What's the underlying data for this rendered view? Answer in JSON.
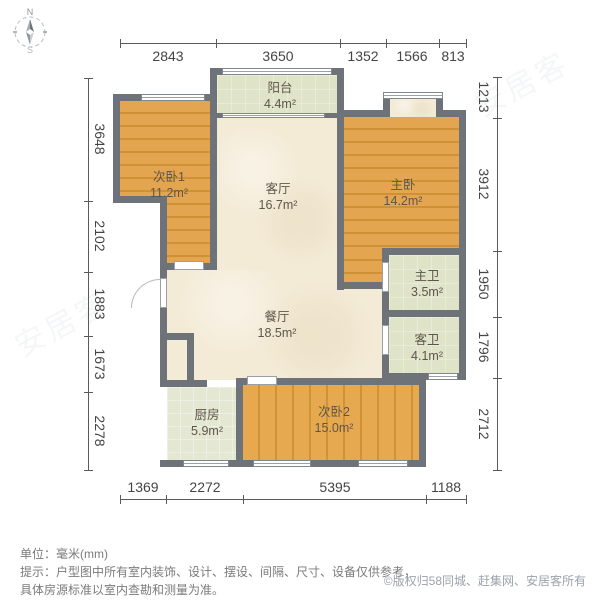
{
  "compass": {
    "north": "N",
    "south": "S"
  },
  "rooms": [
    {
      "id": "bedroom2-1",
      "name": "次卧1",
      "area": "11.2m²",
      "floor": "wood"
    },
    {
      "id": "balcony",
      "name": "阳台",
      "area": "4.4m²",
      "floor": "tile"
    },
    {
      "id": "living",
      "name": "客厅",
      "area": "16.7m²",
      "floor": "marble"
    },
    {
      "id": "master",
      "name": "主卧",
      "area": "14.2m²",
      "floor": "wood"
    },
    {
      "id": "master-bath",
      "name": "主卫",
      "area": "3.5m²",
      "floor": "tile"
    },
    {
      "id": "guest-bath",
      "name": "客卫",
      "area": "4.1m²",
      "floor": "tile"
    },
    {
      "id": "dining",
      "name": "餐厅",
      "area": "18.5m²",
      "floor": "marble"
    },
    {
      "id": "kitchen",
      "name": "厨房",
      "area": "5.9m²",
      "floor": "tile"
    },
    {
      "id": "bedroom2-2",
      "name": "次卧2",
      "area": "15.0m²",
      "floor": "wood"
    }
  ],
  "dimensions": {
    "top": [
      "2843",
      "3650",
      "1352",
      "1566",
      "813"
    ],
    "left": [
      "3648",
      "2102",
      "1883",
      "1673",
      "2278"
    ],
    "right": [
      "1213",
      "3912",
      "1950",
      "1796",
      "2712"
    ],
    "bottom": [
      "1369",
      "2272",
      "5395",
      "1188"
    ]
  },
  "notes": {
    "unit": "单位：毫米(mm)",
    "tip_line1": "提示：户型图中所有室内装饰、设计、摆设、间隔、尺寸、设备仅供参考，",
    "tip_line2": "具体房源标准以室内查勘和测量为准。"
  },
  "copyright": "©版权归58同城、赶集网、安居客所有",
  "colors": {
    "wall": "#6e737a",
    "wood_floor": "#dfa04b",
    "marble_floor": "#f4ebd7",
    "tile_floor": "#dfe3c8",
    "dimension_text": "#454545"
  }
}
